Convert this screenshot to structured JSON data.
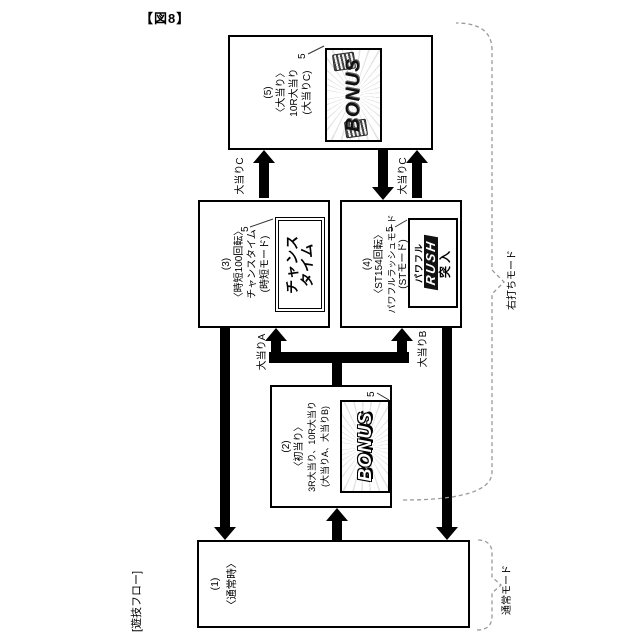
{
  "figure": {
    "title": "【図8】",
    "flow_label": "[遊技フロー]"
  },
  "modes": {
    "right_strike": "右打ちモード",
    "normal": "通常モード"
  },
  "boxes": {
    "b1": {
      "lines": [
        "(1)",
        "〈通常時〉"
      ]
    },
    "b2": {
      "lines": [
        "(2)",
        "〈初当り〉",
        "3R大当り、10R大当り",
        "(大当りA、大当りB)"
      ],
      "ref": "5",
      "screen": {
        "text": "BONUS"
      }
    },
    "b3": {
      "lines": [
        "(3)",
        "〈時短100回転〉",
        "チャンスタイム",
        "(時短モード)"
      ],
      "ref": "5",
      "screen": {
        "line1": "チャンス",
        "line2": "タイム"
      }
    },
    "b4": {
      "lines": [
        "(4)",
        "〈ST154回転〉",
        "パワフルラッシュモード",
        "(STモード)"
      ],
      "ref": "5",
      "screen": {
        "line1": "パワフル",
        "line2": "RUSH",
        "line3": "突入"
      }
    },
    "b5": {
      "lines": [
        "(5)",
        "〈大当り〉",
        "10R大当り",
        "(大当りC)"
      ],
      "ref": "5",
      "screen": {
        "text": "BONUS"
      }
    }
  },
  "arrows": {
    "taiatari_c_left": "大当りC",
    "taiatari_c_right": "大当りC",
    "taiatari_a": "大当りA",
    "taiatari_b": "大当りB"
  }
}
